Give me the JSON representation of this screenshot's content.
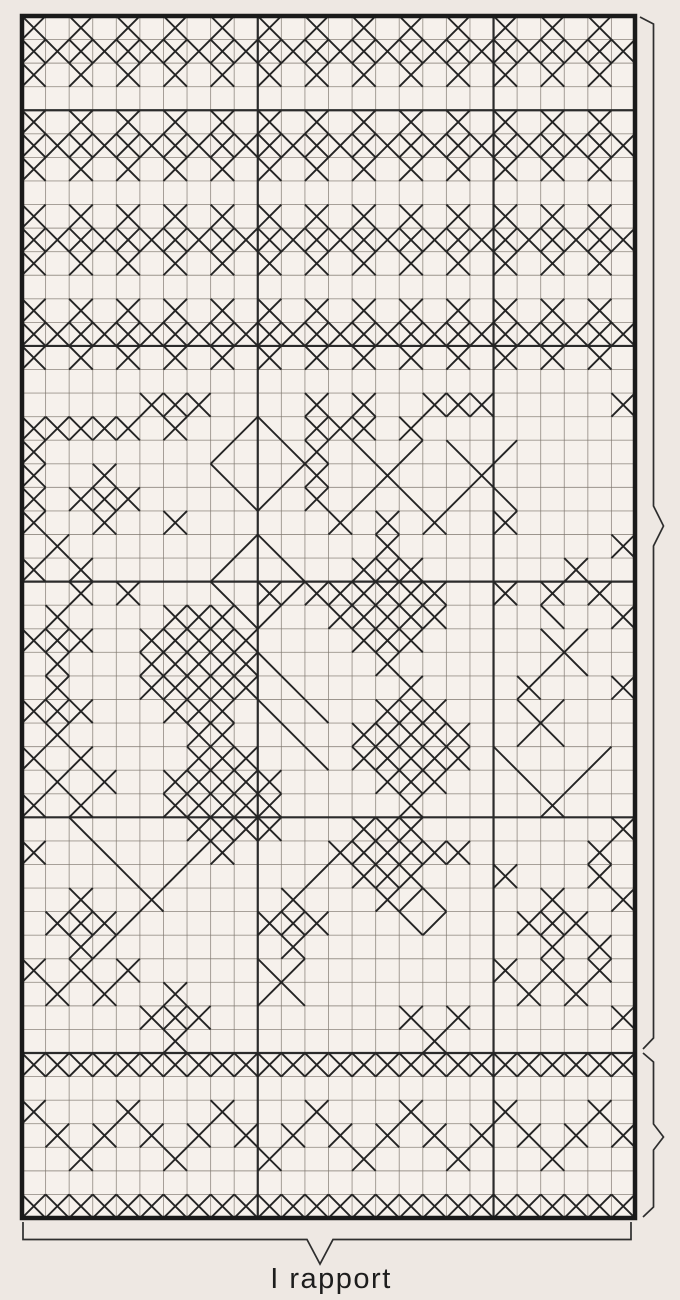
{
  "page": {
    "background": "#eee8e3"
  },
  "chart": {
    "type": "cross_stitch_pattern_grid",
    "columns": 26,
    "rows": 51,
    "cell_px": 23.6,
    "background": "#f6f1ec",
    "colors": {
      "stitch": "#242424",
      "grid_line": "#7d756d",
      "major_line": "#2b2b2b",
      "border": "#1a1a1a",
      "bracket": "#2e2e2e"
    },
    "major_columns_after": [
      10,
      20
    ],
    "major_rows_after": [
      4,
      14,
      24,
      34,
      44
    ]
  },
  "pattern": {
    "legend": {
      "X": "cross stitch",
      "/": "diagonal stitch up",
      "b": "diagonal stitch down",
      ".": "empty cell"
    },
    "grid": [
      "X.X.X.X.X.X.X.X.X.X.X.X.X.",
      "XXXXXXXXXXXXXXXXXXXXXXXXXX",
      "X.X.X.X.X.X.X.X.X.X.X.X.X.",
      "..........................",
      "X.X.X.X.X.X.X.X.X.X.X.X.X.",
      "XXXXXXXXXXXXXXXXXXXXXXXXXX",
      "X.X.X.X.X.X.X.X.X.X.X.X.X.",
      "..........................",
      "X.X.X.X.X.X.X.X.X.X.X.X.X.",
      "XXXXXXXXXXXXXXXXXXXXXXXXXX",
      "X.X.X.X.X.X.X.X.X.X.X.X.X.",
      "..........................",
      "X.X.X.X.X.X.X.X.X.X.X.X.X.",
      "XXXXXXXXXXXXXXXXXXXXXXXXXX",
      "X.X.X.X.X.X.X.X.X.X.X.X.X.",
      "..........................",
      ".....XXX....X.X..XXX.....X",
      "XXXXX.X../b.XXX.X.........",
      "X......./..bX.b./.b./.....",
      "X..X....b../X..X...X......",
      "X.XXX....b/.X./.b./.b.....",
      "X..X..X......X.X.X..X.....",
      ".X......./b....X.........X",
      "X.X...../..b..XXX......X..",
      "..X.X...b.X/XXXXXX..X.X.X.",
      ".X....XXXb/..XXXXX....b..X",
      "XXX..XXXXX....XXX.....b/..",
      ".X...XXXXXb....X....../b..",
      ".X...XXXXX.b....X....X...X",
      "XXX...XXX.b.b..XXX...b/...",
      ".X.....XX..b..XXXXX../b...",
      "X.X....XXX..b.XXXXX.b.../.",
      ".X.X..XXXXX....XXX...b./..",
      "X.X...XXXXX.....X.....X...",
      "..b....XXXX...XXX........X",
      "X..b.../X....XXXXXX.....X.",
      "....b./...../.XXX...X...X.",
      "..X..X.....X...X/b....X..X",
      ".XXX/.....XXX...b/...XXX..",
      "..X/.......X..........X.X.",
      "X.X.X.....b/........X.X.X.",
      ".X.X..X.../b.........X.X..",
      ".....XXX........X.X......X",
      "......X..........X........",
      "XXXXXXXXXXXXXXXXXXXXXXXXXX",
      "..........................",
      "X...X...X...X...X...X...X.",
      ".X.X.X.X.X.X.X.X.X.X.X.X.X",
      "..X...X...X...X...X...X...",
      "..........................",
      "XXXXXXXXXXXXXXXXXXXXXXXXXX"
    ]
  },
  "annotations": {
    "repeat_label": "I rapport"
  }
}
